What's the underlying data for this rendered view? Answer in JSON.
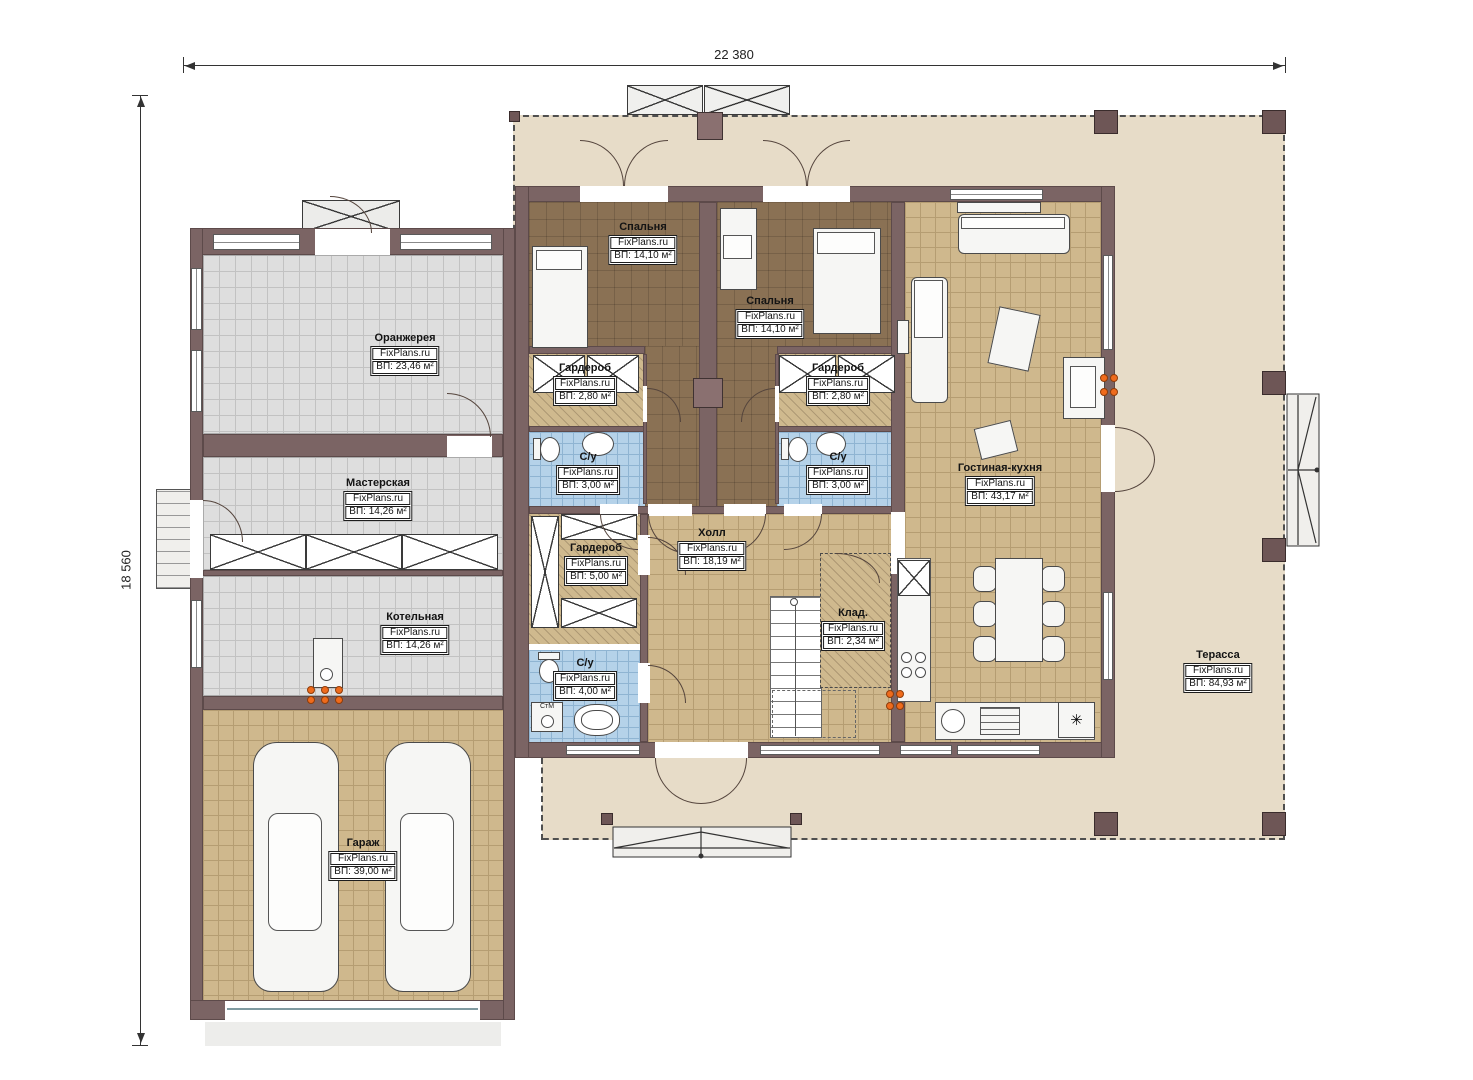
{
  "plan": {
    "dimensions": {
      "width_label": "22 380",
      "height_label": "18 560"
    },
    "rooms": {
      "orangery": {
        "name": "Оранжерея",
        "brand": "FixPlans.ru",
        "area": "ВП: 23,46 м²"
      },
      "workshop": {
        "name": "Мастерская",
        "brand": "FixPlans.ru",
        "area": "ВП: 14,26 м²"
      },
      "boiler": {
        "name": "Котельная",
        "brand": "FixPlans.ru",
        "area": "ВП: 14,26 м²"
      },
      "garage": {
        "name": "Гараж",
        "brand": "FixPlans.ru",
        "area": "ВП: 39,00 м²"
      },
      "bedroom1": {
        "name": "Спальня",
        "brand": "FixPlans.ru",
        "area": "ВП: 14,10 м²"
      },
      "bedroom2": {
        "name": "Спальня",
        "brand": "FixPlans.ru",
        "area": "ВП: 14,10 м²"
      },
      "wardrobe1": {
        "name": "Гардероб",
        "brand": "FixPlans.ru",
        "area": "ВП: 2,80 м²"
      },
      "wardrobe2": {
        "name": "Гардероб",
        "brand": "FixPlans.ru",
        "area": "ВП: 2,80 м²"
      },
      "bath1": {
        "name": "С/у",
        "brand": "FixPlans.ru",
        "area": "ВП: 3,00 м²"
      },
      "bath2": {
        "name": "С/у",
        "brand": "FixPlans.ru",
        "area": "ВП: 3,00 м²"
      },
      "hall": {
        "name": "Холл",
        "brand": "FixPlans.ru",
        "area": "ВП: 18,19 м²"
      },
      "wardrobe3": {
        "name": "Гардероб",
        "brand": "FixPlans.ru",
        "area": "ВП: 5,00 м²"
      },
      "bath3": {
        "name": "С/у",
        "brand": "FixPlans.ru",
        "area": "ВП: 4,00 м²"
      },
      "storage": {
        "name": "Клад.",
        "brand": "FixPlans.ru",
        "area": "ВП: 2,34 м²"
      },
      "living": {
        "name": "Гостиная-кухня",
        "brand": "FixPlans.ru",
        "area": "ВП: 43,17 м²"
      },
      "terrace": {
        "name": "Терасса",
        "brand": "FixPlans.ru",
        "area": "ВП: 84,93 м²"
      }
    },
    "annotations": {
      "washing_machine": "СтМ"
    },
    "symbols": {
      "fridge": "✳"
    },
    "colors": {
      "wall": "#7b6464",
      "terrace": "#e7dcc8",
      "bedroom_floor": "#8a7154",
      "tile_tan": "#cfb88d",
      "tile_grey": "#dedede",
      "tile_blue": "#b5d2e9",
      "accent_orange": "#ef6b1c"
    }
  }
}
